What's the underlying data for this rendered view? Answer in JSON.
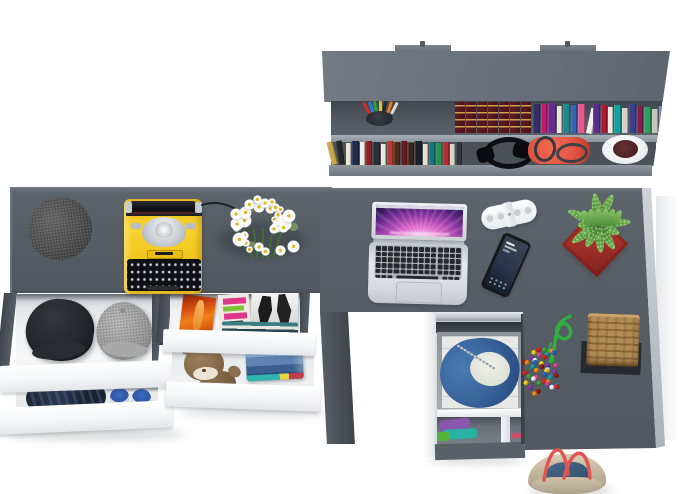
{
  "scene": {
    "title": "Top view product render: gray L-shaped desk set with wall shelf, open white drawers and lifestyle accessories",
    "background": "#ffffff",
    "desk_color": "#5c6269",
    "desk_edge_highlight": "#7c828a",
    "drawer_front_color": "#f5f6f8"
  },
  "shelf": {
    "top_color": "#6b717b",
    "cavity_color": "#4e535b",
    "board_color": "#999fa7",
    "maroon_set": {
      "count": 7,
      "color_a": "#5e1b23",
      "color_b": "#4a121a",
      "stripe": "#c9a24a"
    },
    "upper_books": [
      [
        "#312f6b",
        7,
        29,
        0
      ],
      [
        "#c2186e",
        6,
        29,
        0
      ],
      [
        "#6e2a8a",
        8,
        30,
        0
      ],
      [
        "#e8e5de",
        5,
        27,
        0
      ],
      [
        "#1b8a8f",
        7,
        29,
        0
      ],
      [
        "#2f65b5",
        6,
        28,
        0
      ],
      [
        "#e45a92",
        7,
        29,
        0
      ],
      [
        "#f0eee6",
        6,
        26,
        12
      ],
      [
        "#5a2d8c",
        7,
        29,
        0
      ],
      [
        "#b01735",
        6,
        28,
        0
      ],
      [
        "#efe9df",
        5,
        26,
        0
      ],
      [
        "#15a0a0",
        7,
        28,
        0
      ],
      [
        "#d6d2c8",
        6,
        25,
        0
      ],
      [
        "#3b3f8f",
        7,
        29,
        0
      ],
      [
        "#8c1c50",
        6,
        27,
        0
      ],
      [
        "#2e9e62",
        7,
        26,
        0
      ],
      [
        "#c9c4ba",
        6,
        24,
        0
      ],
      [
        "#7486b9",
        6,
        27,
        0
      ]
    ],
    "lower_books": [
      [
        "#caa64c",
        6,
        23,
        -14
      ],
      [
        "#23262b",
        6,
        24,
        -8
      ],
      [
        "#e9e4d8",
        5,
        22,
        0
      ],
      [
        "#1f2a4d",
        7,
        24,
        0
      ],
      [
        "#f0ece2",
        5,
        23,
        0
      ],
      [
        "#8a1f24",
        6,
        24,
        0
      ],
      [
        "#2a2d33",
        7,
        23,
        0
      ],
      [
        "#ece7db",
        5,
        21,
        0
      ],
      [
        "#c03a30",
        6,
        24,
        0
      ],
      [
        "#4a2c1c",
        6,
        23,
        0
      ],
      [
        "#6b1a20",
        6,
        24,
        0
      ],
      [
        "#3a2418",
        6,
        22,
        0
      ],
      [
        "#1c1f2b",
        7,
        24,
        0
      ],
      [
        "#e6e0d2",
        5,
        21,
        0
      ],
      [
        "#14777c",
        6,
        23,
        0
      ],
      [
        "#2e8f4a",
        6,
        22,
        0
      ],
      [
        "#b52a2e",
        6,
        23,
        0
      ],
      [
        "#d9d4c9",
        5,
        21,
        0
      ],
      [
        "#30343b",
        6,
        23,
        0
      ]
    ],
    "pencil_cup": {
      "cup": "#2e3339",
      "pencils": [
        "#d42a2a",
        "#2a7ad4",
        "#28a04a",
        "#e8c21a",
        "#24262a",
        "#e87a1a",
        "#d8d8d8"
      ]
    },
    "headphones_color": "#0d0e11",
    "red_bag": {
      "body": "#e25443",
      "handles": "#3a3f46"
    },
    "plant_cup": {
      "pot": "#f2f4f6",
      "plant": "#4a2326"
    }
  },
  "left_desk": {
    "gray_cap_color": "#474747",
    "typewriter": {
      "body": "#f5c91d",
      "platen": "#17181c",
      "keys": "#26282d",
      "mechanism": "#d9dde1"
    },
    "flowers": {
      "petal": "#ffffff",
      "center": "#e3b81c",
      "stem": "#3e6f33",
      "count": 30
    }
  },
  "left_drawers": {
    "stack_a": {
      "black_cap": "#26272c",
      "gray_cap": "#a3a3a3",
      "jeans": "#232c3d",
      "shoes": "#2f5ca6"
    },
    "stack_b": {
      "magazine_orange": "#e06012",
      "magazine_pink": "#e0368c",
      "magazine_green": "#7ec43a",
      "teddy": "#8d7350",
      "jeans_stack": [
        "#8fb0d4",
        "#5e85b2",
        "#3a5f8f",
        "#2c4a74"
      ]
    }
  },
  "right_desk": {
    "laptop": {
      "body": "#d9dde1",
      "keys": "#26282c",
      "aurora": [
        "#ffeaf8",
        "#e070cf",
        "#a844ae",
        "#3a1a62"
      ]
    },
    "speaker_color": "#f4f6f8",
    "phone_color": "#191a1e",
    "plant": {
      "pot": "#b13a30",
      "leaves": [
        "#76b455",
        "#4e8f3a",
        "#3a7030"
      ]
    },
    "rope_color": "#2fae44",
    "bead_colors": [
      "#d3262a",
      "#e88a1a",
      "#e8cf1d",
      "#3da43a",
      "#2a65c4",
      "#7a3fa8",
      "#d84a8c",
      "#18a0a8",
      "#8a2418",
      "#f0f0f0"
    ],
    "basket": {
      "body": "#b28c55",
      "weave": "#6e4c22",
      "mat": "#26292e"
    },
    "bottom_drawer": {
      "denim": "#3e6ca3",
      "liner": "#e9eae8",
      "clothes": [
        "#8a56b0",
        "#28b2a2",
        "#55b23a",
        "#d04a6a"
      ]
    },
    "tote": {
      "canvas": "#c9bca6",
      "denim": "#3d5a7a",
      "straps": "#e05552"
    }
  }
}
